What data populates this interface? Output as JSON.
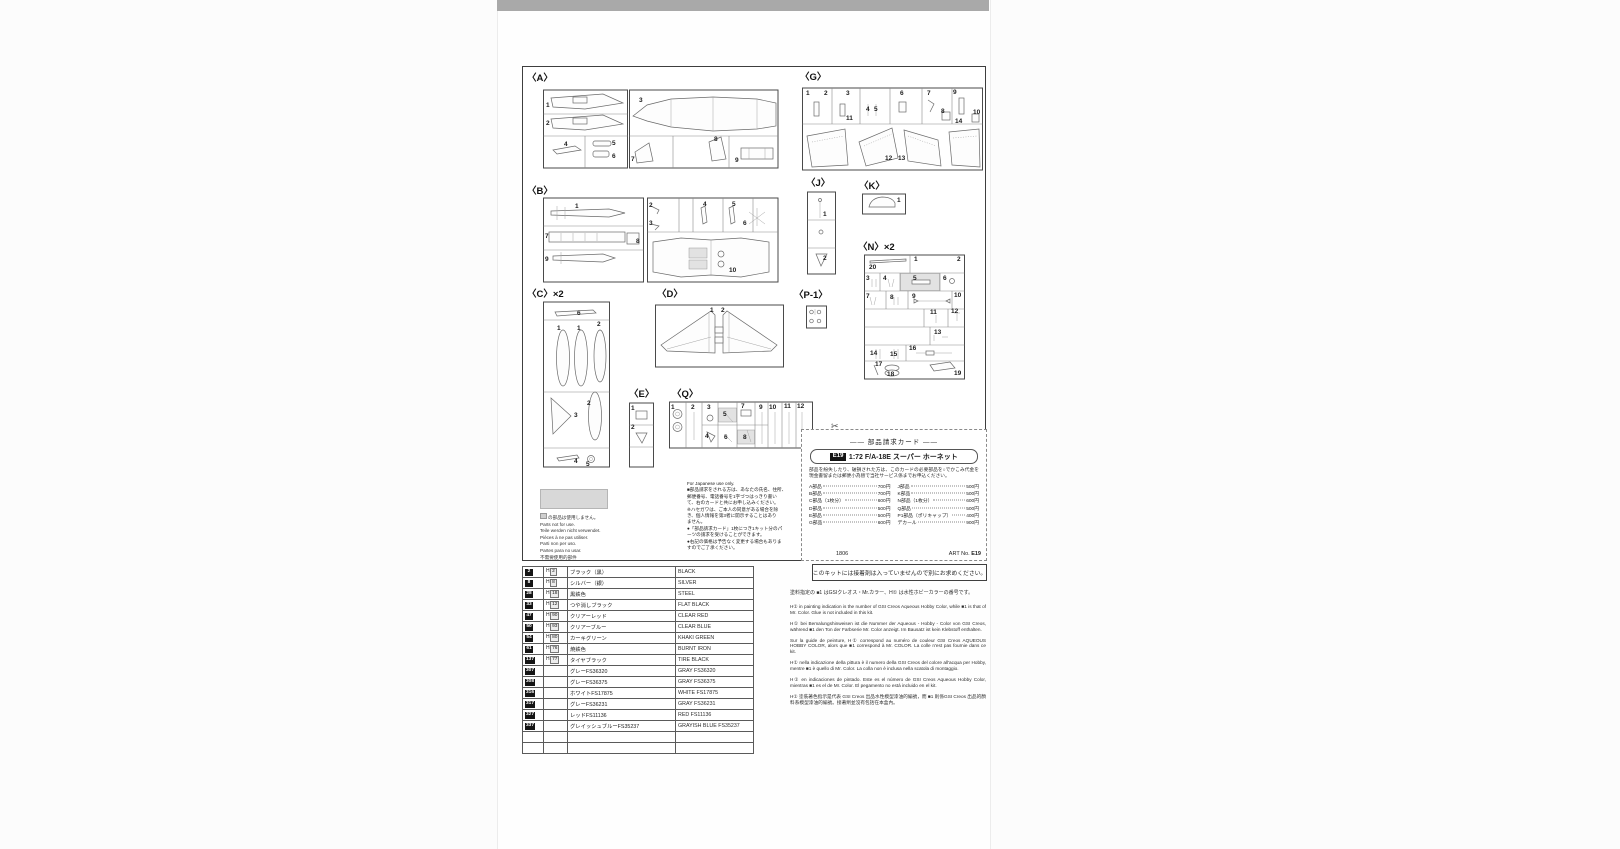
{
  "sprues": {
    "A": {
      "label": "〈A〉",
      "parts": [
        "1",
        "2",
        "3",
        "4",
        "5",
        "6",
        "7",
        "8",
        "9"
      ]
    },
    "B": {
      "label": "〈B〉",
      "parts": [
        "1",
        "2",
        "3",
        "4",
        "5",
        "6",
        "7",
        "8",
        "9",
        "10"
      ]
    },
    "C": {
      "label": "〈C〉×2",
      "parts": [
        "6",
        "1",
        "1",
        "2",
        "2",
        "3",
        "4",
        "5"
      ]
    },
    "D": {
      "label": "〈D〉",
      "parts": [
        "1",
        "2"
      ]
    },
    "E": {
      "label": "〈E〉",
      "parts": [
        "1",
        "2"
      ]
    },
    "G": {
      "label": "〈G〉",
      "parts": [
        "1",
        "2",
        "3",
        "4",
        "5",
        "6",
        "7",
        "8",
        "9",
        "10",
        "11",
        "12",
        "13",
        "14"
      ]
    },
    "J": {
      "label": "〈J〉",
      "parts": [
        "1",
        "2"
      ]
    },
    "K": {
      "label": "〈K〉",
      "parts": [
        "1"
      ]
    },
    "N": {
      "label": "〈N〉×2",
      "parts": [
        "20",
        "1",
        "2",
        "3",
        "4",
        "5",
        "6",
        "7",
        "8",
        "9",
        "10",
        "11",
        "12",
        "13",
        "14",
        "15",
        "16",
        "17",
        "18",
        "19"
      ]
    },
    "P1": {
      "label": "〈P-1〉",
      "parts": []
    },
    "Q": {
      "label": "〈Q〉",
      "parts": [
        "1",
        "2",
        "3",
        "4",
        "5",
        "6",
        "7",
        "8",
        "9",
        "10",
        "11",
        "12"
      ]
    }
  },
  "parts_card": {
    "scissors": "✂",
    "title": "―― 部品請求カード ――",
    "kit_code": "E19",
    "kit_name": "1:72 F/A-18E スーパー ホーネット",
    "body": "部品を紛失したり、破損された方は、このカードの必要部品を○でかこみ代金を現金書留または郵便小為替で当社サービス係までお申込ください。",
    "prices": [
      {
        "l": "A部品",
        "lp": "700円",
        "r": "J部品",
        "rp": "500円"
      },
      {
        "l": "B部品",
        "lp": "700円",
        "r": "K部品",
        "rp": "500円"
      },
      {
        "l": "C部品（1枚分）",
        "lp": "600円",
        "r": "N部品（1枚分）",
        "rp": "600円"
      },
      {
        "l": "D部品",
        "lp": "500円",
        "r": "Q部品",
        "rp": "500円"
      },
      {
        "l": "E部品",
        "lp": "500円",
        "r": "P1部品（ポリキャップ）",
        "rp": "400円"
      },
      {
        "l": "G部品",
        "lp": "600円",
        "r": "デカール",
        "rp": "900円"
      }
    ],
    "footer_left": "1806",
    "footer_right_label": "ART No.",
    "footer_right_code": "E19"
  },
  "japanese_only": {
    "lines": [
      "For Japanese use only.",
      "■部品請求をされる方は、あなたの氏名、住所、",
      "郵便番号、電話番号を1字づつはっきり書い",
      "て、右のカードと共にお申し込みください。",
      "※ハセガワは、ご本人の同意がある場合を除",
      "き、個人情報を第3者に開示することはあり",
      "ません。",
      "●「部品請求カード」1枚につき1キット分のパ",
      "ーツの請求を受けることができます。",
      "●右記の価格は予告なく変更する場合もありま",
      "すのでご了承ください。"
    ]
  },
  "not_for_use": {
    "first_line": "の部品は使用しません。",
    "lines": [
      "Parts not for use.",
      "Teile werden nicht verwendet.",
      "Pièces à ne pas utiliser.",
      "Parti non per uso.",
      "Partes para no usar.",
      "不需要使用的部件"
    ]
  },
  "paint_table": {
    "rows": [
      {
        "mr": "2",
        "aq": "2",
        "jp": "ブラック（黒）",
        "en": "BLACK"
      },
      {
        "mr": "8",
        "aq": "8",
        "jp": "シルバー（銀）",
        "en": "SILVER"
      },
      {
        "mr": "28",
        "aq": "18",
        "jp": "黒鉄色",
        "en": "STEEL"
      },
      {
        "mr": "33",
        "aq": "12",
        "jp": "つや消しブラック",
        "en": "FLAT BLACK"
      },
      {
        "mr": "47",
        "aq": "90",
        "jp": "クリアーレッド",
        "en": "CLEAR RED"
      },
      {
        "mr": "50",
        "aq": "93",
        "jp": "クリアーブルー",
        "en": "CLEAR BLUE"
      },
      {
        "mr": "54",
        "aq": "80",
        "jp": "カーキグリーン",
        "en": "KHAKI GREEN"
      },
      {
        "mr": "61",
        "aq": "76",
        "jp": "焼鉄色",
        "en": "BURNT IRON"
      },
      {
        "mr": "137",
        "aq": "77",
        "jp": "タイヤブラック",
        "en": "TIRE BLACK"
      },
      {
        "mr": "307",
        "aq": "",
        "jp": "グレーFS36320",
        "en": "GRAY FS36320"
      },
      {
        "mr": "308",
        "aq": "",
        "jp": "グレーFS36375",
        "en": "GRAY FS36375"
      },
      {
        "mr": "316",
        "aq": "",
        "jp": "ホワイトFS17875",
        "en": "WHITE FS17875"
      },
      {
        "mr": "317",
        "aq": "",
        "jp": "グレーFS36231",
        "en": "GRAY FS36231"
      },
      {
        "mr": "327",
        "aq": "",
        "jp": "レッドFS11136",
        "en": "RED FS11136"
      },
      {
        "mr": "337",
        "aq": "",
        "jp": "グレイッシュブルーFS35237",
        "en": "GRAYISH BLUE FS35237"
      },
      {
        "mr": "",
        "aq": "",
        "jp": "",
        "en": ""
      },
      {
        "mr": "",
        "aq": "",
        "jp": "",
        "en": ""
      }
    ]
  },
  "notes": {
    "glue_note": "このキットには接着剤は入っていませんので別にお求めください。",
    "paragraphs": [
      "塗料指定の ■1 はGSIクレオス・Mr.カラー、H① は水性ホビーカラーの番号です。",
      "H① in painting indication is the number of GSI Creos Aqueous Hobby Color, while ■1 is that of Mr. Color. Glue is not included in this kit.",
      "H① bei Bemalungshinweisen ist die Nummer der Aqueous - Hobby - Color von GSI Creos, während ■1 den Ton der Farbserie Mr. Color anzeigt. Im Bausatz ist kein Klebstoff enthalten.",
      "Sur la guide de peinture, H① correspond au numéro de couleur GSI Creos AQUEOUS HOBBY COLOR, alors que ■1 correspond à Mr. COLOR. La colle n'est pas fournie dans ce kit.",
      "H① nella indicazione della pittura è il numero della GSI Creos del colore all'acqua per Hobby, mentre ■1 è quello di Mr. Color. La colla non è inclusa nella scatola di montaggio.",
      "H① en indicaciones de pintado. Este es el número de GSI Creos Aqueous Hobby Color, mientras ■1 es el de Mr. Color. El pegamento no está incluido en el kit.",
      "H① 塗裝著色指示是代表 GSI Creos 出品水性模型漆油的編號，而 ■1 則係GSI Creos 出品的顏料系模型漆油的編號。接著劑並沒有包括在本盒內。"
    ]
  }
}
